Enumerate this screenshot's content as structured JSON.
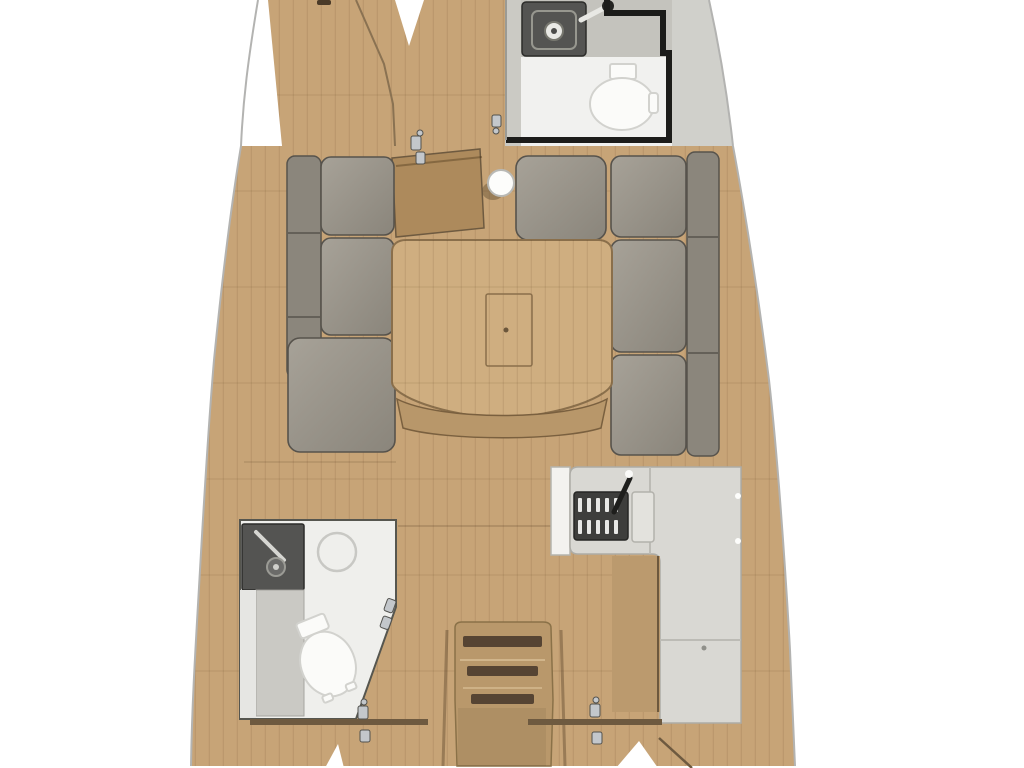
{
  "meta": {
    "title": "Sailboat interior floor plan — top view",
    "description": "3D-rendered yacht layout plan, bow at top, stern at bottom, no visible text"
  },
  "colors": {
    "bg": "#ffffff",
    "hull_line": "#b3b3b1",
    "deck_gray": "#d0d0cb",
    "wood": "#c7a477",
    "wood_dark": "#b5936a",
    "wood_edge": "#8a7252",
    "wood_deep": "#6e5a40",
    "door_wood": "#ad8a5c",
    "table_wood": "#cfae80",
    "bench_wood": "#b8976a",
    "stair_wood": "#b9986b",
    "cabinet_wood": "#bb9a6e",
    "slot_dark": "#564433",
    "cushion_light": "#a49f95",
    "cushion_mid": "#948f85",
    "cushion_dark": "#8b867c",
    "cushion_edge": "#57534c",
    "counter": "#d9d8d3",
    "counter_edge": "#adaca6",
    "fixture_white": "#fbfbf9",
    "fixture_edge": "#d2d2ce",
    "head_floor": "#f1f1ef",
    "head_gray": "#c4c3bd",
    "wall_black": "#1c1c1a",
    "wall_gray": "#9b9b95",
    "sink_dark": "#545452",
    "stove_dark": "#2c2c2a",
    "metal": "#c3c7cb",
    "shower_ring": "#c8c8c4"
  },
  "rooms": {
    "forward_cabin": {
      "label": "Forward cabin V-berth"
    },
    "forward_head": {
      "label": "Forward head"
    },
    "salon": {
      "label": "Salon"
    },
    "galley": {
      "label": "L-shaped galley"
    },
    "aft_head": {
      "label": "Aft head with shower"
    },
    "companionway": {
      "label": "Companionway stairs"
    },
    "aft_cabin_port": {
      "label": "Aft cabin (port)"
    },
    "aft_cabin_starboard": {
      "label": "Aft cabin (starboard)"
    }
  },
  "fixtures": [
    {
      "icon": "toilet-icon",
      "room": "forward_head"
    },
    {
      "icon": "sink-icon",
      "room": "forward_head"
    },
    {
      "icon": "toilet-icon",
      "room": "aft_head"
    },
    {
      "icon": "sink-icon",
      "room": "aft_head"
    },
    {
      "icon": "shower-ring-icon",
      "room": "aft_head"
    },
    {
      "icon": "stove-grate-icon",
      "room": "galley"
    },
    {
      "icon": "faucet-icon",
      "room": "galley"
    },
    {
      "icon": "salon-table-icon",
      "room": "salon"
    },
    {
      "icon": "mast-post-icon",
      "room": "salon"
    },
    {
      "icon": "stairs-icon",
      "room": "companionway"
    },
    {
      "icon": "door-hinge-icon",
      "room": "salon"
    }
  ],
  "counts": {
    "port_settee_seat_cushions": 3,
    "starboard_settee_seat_cushions": 3,
    "forward_seat_cushions": 1,
    "stair_steps": 3
  }
}
